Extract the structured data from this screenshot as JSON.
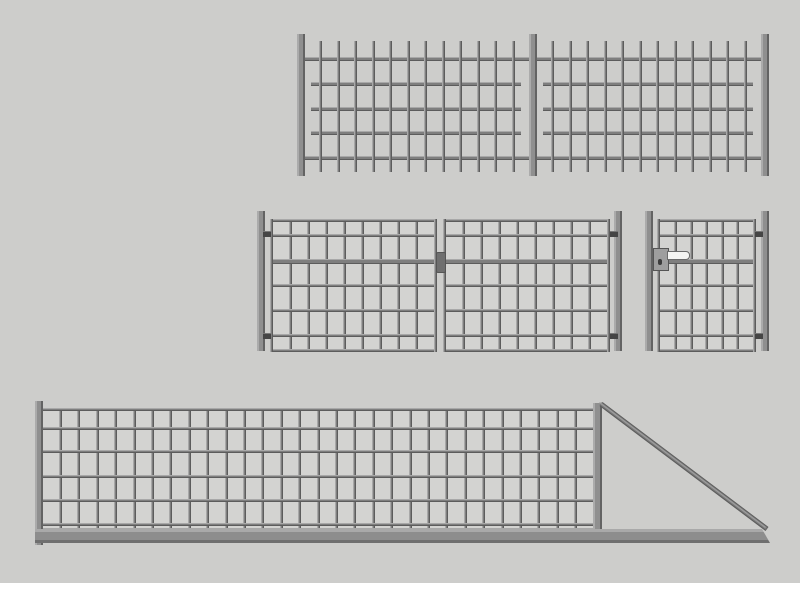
{
  "drawing": {
    "title": "fence-and-gates-technical-drawing",
    "canvas": {
      "w": 800,
      "h": 600,
      "background": "#cdcdcb",
      "bottom_strip": {
        "color": "#ffffff",
        "y": 583,
        "h": 17
      }
    },
    "palette": {
      "bar": "#7e7e7e",
      "bar_light": "#a8a8a8",
      "bar_dark": "#5c5c5c",
      "post": "#8f8f8f",
      "post_light": "#ababab",
      "post_edge": "#636363",
      "mesh_bg": "#d3d3d1",
      "hinge": "#454545",
      "latch": "#6f6f6f",
      "lock_body": "#9e9e9e",
      "lock_edge": "#555555",
      "handle": "#f4f4f2",
      "handle_edge": "#6a6a6a",
      "keyhole": "#3c3c3c",
      "beam": "#8d8d8d",
      "beam_light": "#a9a9a9",
      "beam_dark": "#6f6f6f",
      "brace": "#7b7b7b",
      "brace_light": "#9e9e9e"
    },
    "fence_panel": {
      "component": "bar-fence-two-panels",
      "posts": [
        {
          "x": 297,
          "y": 34,
          "w": 8,
          "h": 142
        },
        {
          "x": 529,
          "y": 34,
          "w": 8,
          "h": 142
        },
        {
          "x": 761,
          "y": 34,
          "w": 8,
          "h": 142
        }
      ],
      "bars": {
        "y": 41,
        "h": 131,
        "w": 3,
        "groups": [
          {
            "x0": 319,
            "count": 12,
            "step": 17.5
          },
          {
            "x0": 551,
            "count": 12,
            "step": 17.5
          }
        ]
      },
      "rails": [
        {
          "x": 303,
          "y": 57,
          "w": 462,
          "h": 4
        },
        {
          "x": 303,
          "y": 156,
          "w": 462,
          "h": 4
        },
        {
          "x": 311,
          "y": 82,
          "w": 210,
          "h": 4
        },
        {
          "x": 311,
          "y": 107,
          "w": 210,
          "h": 4
        },
        {
          "x": 311,
          "y": 131,
          "w": 210,
          "h": 4
        },
        {
          "x": 543,
          "y": 82,
          "w": 210,
          "h": 4
        },
        {
          "x": 543,
          "y": 107,
          "w": 210,
          "h": 4
        },
        {
          "x": 543,
          "y": 131,
          "w": 210,
          "h": 4
        }
      ]
    },
    "double_gate": {
      "component": "double-leaf-mesh-gate",
      "posts": [
        {
          "x": 257,
          "y": 211,
          "w": 8,
          "h": 140
        },
        {
          "x": 614,
          "y": 211,
          "w": 8,
          "h": 140
        }
      ],
      "hinges": [
        {
          "x": 263,
          "y": 231
        },
        {
          "x": 263,
          "y": 333
        },
        {
          "x": 610,
          "y": 231
        },
        {
          "x": 610,
          "y": 333
        }
      ],
      "leaves": [
        {
          "x": 270,
          "y": 219,
          "w": 167,
          "h": 133,
          "cols": 9
        },
        {
          "x": 443,
          "y": 219,
          "w": 167,
          "h": 133,
          "cols": 9
        }
      ],
      "rows": [
        {
          "off": 15,
          "th": 3
        },
        {
          "off": 40,
          "th": 5
        },
        {
          "off": 65,
          "th": 3
        },
        {
          "off": 90,
          "th": 3
        },
        {
          "off": 115,
          "th": 3
        }
      ],
      "latch": {
        "x": 436,
        "y": 252,
        "w": 8,
        "h": 19
      }
    },
    "single_gate": {
      "component": "pedestrian-mesh-gate",
      "posts": [
        {
          "x": 645,
          "y": 211,
          "w": 8,
          "h": 140
        },
        {
          "x": 761,
          "y": 211,
          "w": 8,
          "h": 140
        }
      ],
      "hinges": [
        {
          "x": 755,
          "y": 231
        },
        {
          "x": 755,
          "y": 333
        }
      ],
      "leaves": [
        {
          "x": 657,
          "y": 219,
          "w": 99,
          "h": 133,
          "cols": 6
        }
      ],
      "rows": [
        {
          "off": 15,
          "th": 3
        },
        {
          "off": 40,
          "th": 5
        },
        {
          "off": 65,
          "th": 3
        },
        {
          "off": 90,
          "th": 3
        },
        {
          "off": 115,
          "th": 3
        }
      ],
      "lock": {
        "box": {
          "x": 653,
          "y": 248,
          "w": 14,
          "h": 21
        },
        "keyhole": {
          "x": 658,
          "y": 259,
          "w": 4,
          "h": 6
        },
        "handle": {
          "x": 667,
          "y": 251,
          "w": 21,
          "h": 7
        }
      }
    },
    "sliding_gate": {
      "component": "cantilever-sliding-mesh-gate",
      "posts": [
        {
          "x": 35,
          "y": 401,
          "w": 8,
          "h": 144
        },
        {
          "x": 593,
          "y": 403,
          "w": 9,
          "h": 128
        }
      ],
      "leaves": [
        {
          "x": 39,
          "y": 408,
          "w": 558,
          "h": 123,
          "cols": 30
        }
      ],
      "rows": [
        {
          "off": 19,
          "th": 3
        },
        {
          "off": 42,
          "th": 3
        },
        {
          "off": 67,
          "th": 3
        },
        {
          "off": 91,
          "th": 3
        },
        {
          "off": 115,
          "th": 3
        }
      ],
      "beam": {
        "x": 35,
        "y": 529,
        "w": 735,
        "h": 14,
        "bevel": 8
      },
      "brace": {
        "x1": 601,
        "y1": 404,
        "x2": 767,
        "y2": 529,
        "w": 4
      }
    }
  }
}
